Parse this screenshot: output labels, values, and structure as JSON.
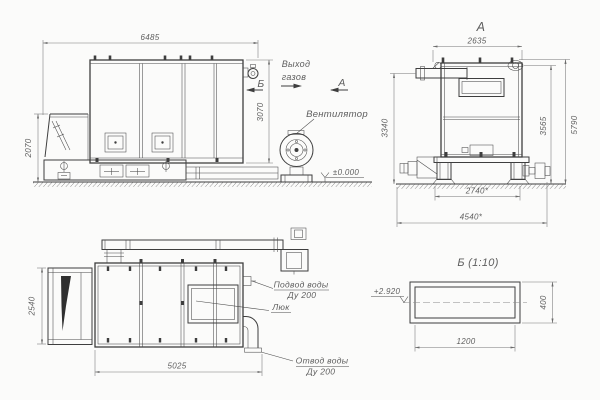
{
  "drawing": {
    "side_view": {
      "dim_width": "6485",
      "dim_height_body": "3070",
      "dim_height_hopper": "2070",
      "marker_view_b": "Б",
      "marker_view_a": "А",
      "label_gas_outlet_1": "Выход",
      "label_gas_outlet_2": "газов",
      "label_fan": "Вентилятор",
      "label_level_zero": "±0.000"
    },
    "front_view": {
      "title": "А",
      "dim_width": "2635",
      "dim_h_pipe": "3340",
      "dim_h_body": "3565",
      "dim_h_total": "5790",
      "dim_base_inner": "2740*",
      "dim_base_outer": "4540*"
    },
    "plan_view": {
      "dim_depth": "2540",
      "dim_length": "5025",
      "label_water_supply": "Подвод воды",
      "label_water_supply_dn": "Ду 200",
      "label_hatch": "Люк",
      "label_water_drain": "Отвод воды",
      "label_water_drain_dn": "Ду 200"
    },
    "detail_view": {
      "title": "Б (1:10)",
      "label_level": "+2.920",
      "dim_width": "1200",
      "dim_height": "400"
    },
    "colors": {
      "line": "#3e3e3e",
      "dim": "#767676",
      "background": "#fbfbfa"
    }
  }
}
